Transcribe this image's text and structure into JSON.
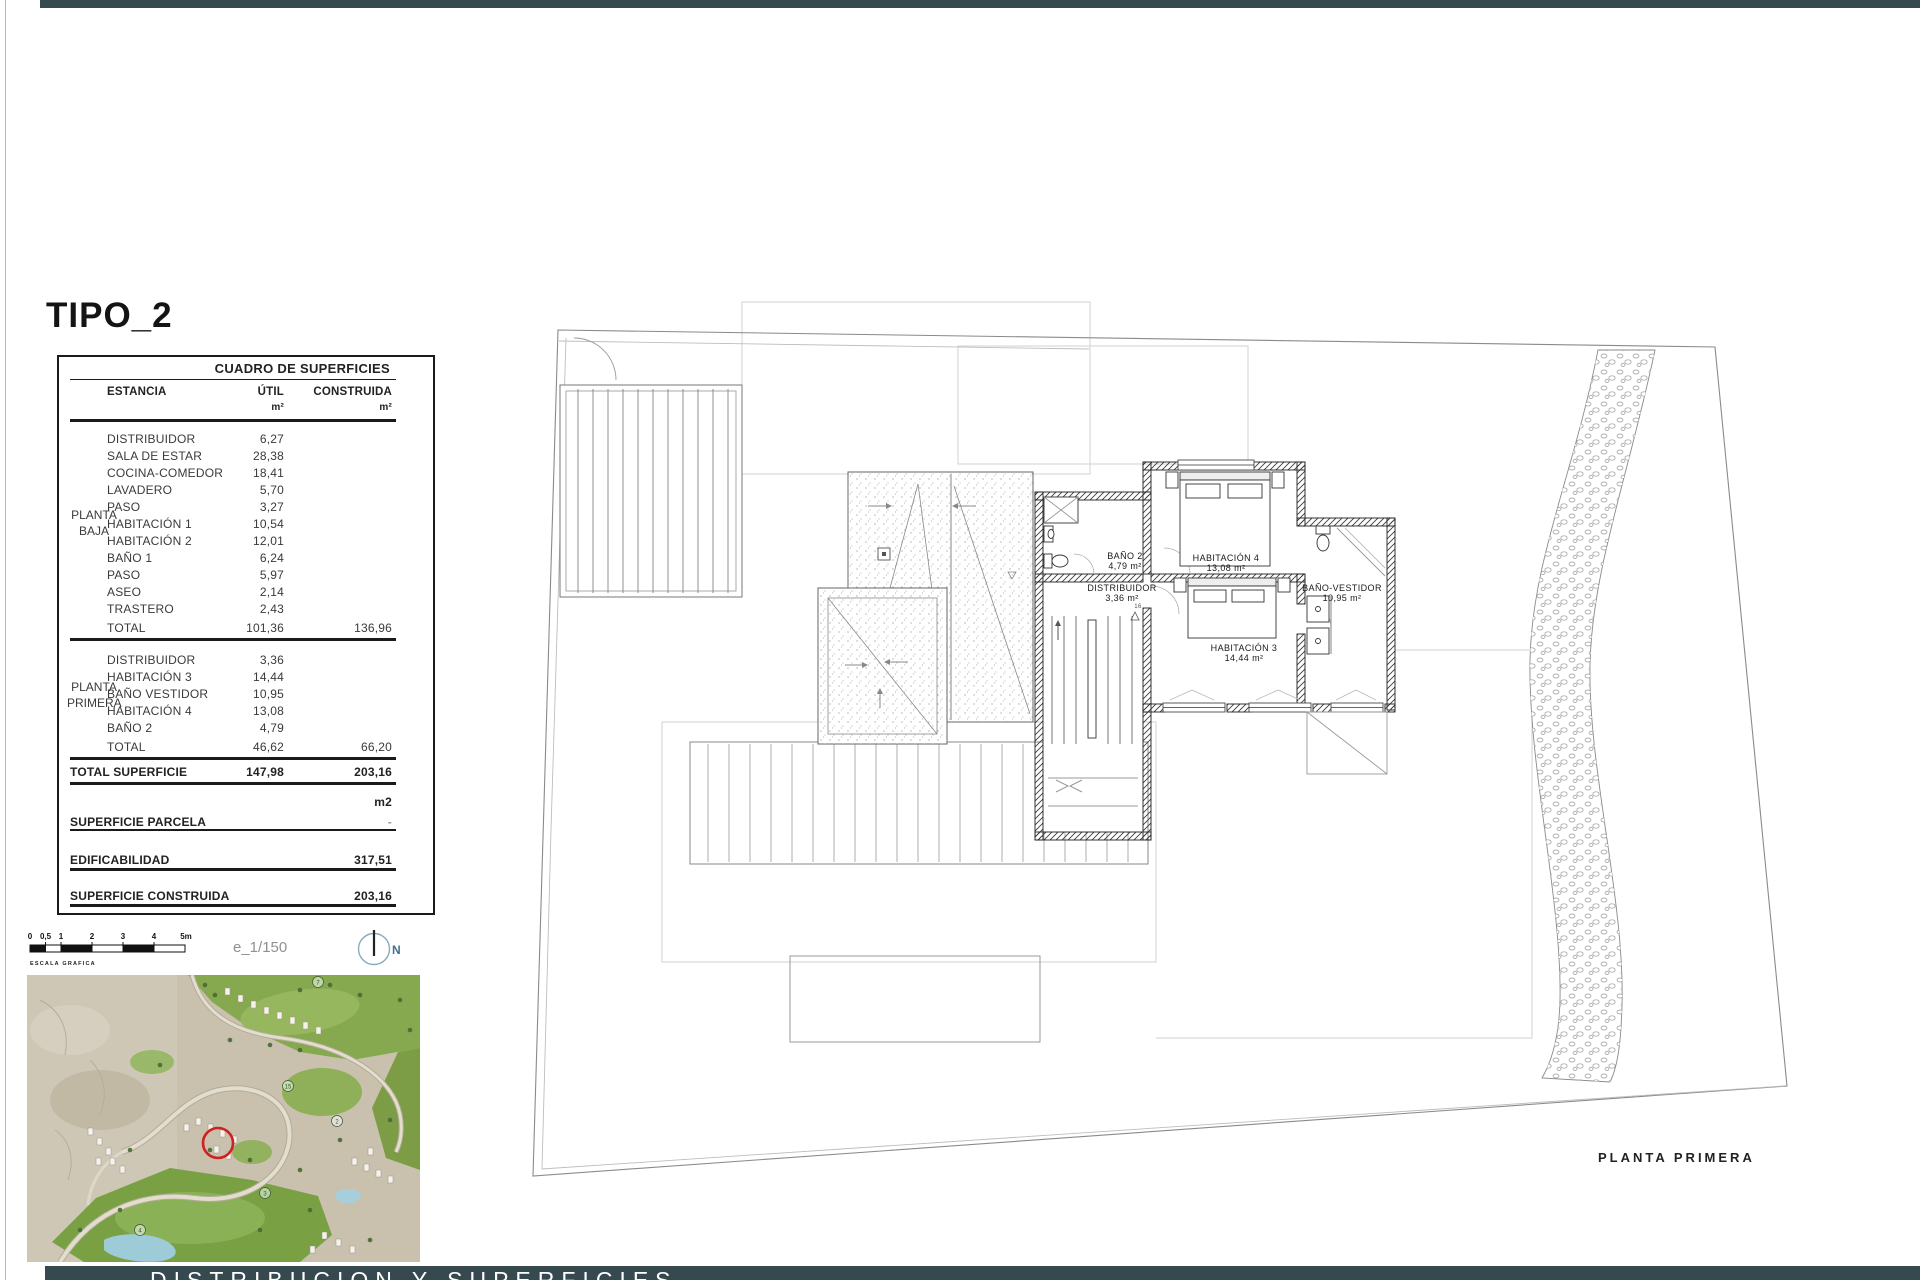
{
  "page": {
    "title": "TIPO_2",
    "footer_text": "DISTRIBUCION Y SUPERFICIES",
    "plan_caption": "PLANTA PRIMERA",
    "scale_text": "e_1/150",
    "scale_caption": "ESCALA GRAFICA",
    "north_label": "N",
    "scale_ticks": [
      "0",
      "0,5",
      "1",
      "2",
      "3",
      "4",
      "5m"
    ],
    "accent_color": "#35494e"
  },
  "table": {
    "title": "CUADRO DE SUPERFICIES",
    "columns": {
      "estancia": "ESTANCIA",
      "util": "ÚTIL",
      "construida": "CONSTRUIDA",
      "unit": "m²"
    },
    "planta_baja": {
      "label_line1": "PLANTA",
      "label_line2": "BAJA",
      "rows": [
        {
          "name": "DISTRIBUIDOR",
          "util": "6,27"
        },
        {
          "name": "SALA DE ESTAR",
          "util": "28,38"
        },
        {
          "name": "COCINA-COMEDOR",
          "util": "18,41"
        },
        {
          "name": "LAVADERO",
          "util": "5,70"
        },
        {
          "name": "PASO",
          "util": "3,27"
        },
        {
          "name": "HABITACIÓN 1",
          "util": "10,54"
        },
        {
          "name": "HABITACIÓN 2",
          "util": "12,01"
        },
        {
          "name": "BAÑO 1",
          "util": "6,24"
        },
        {
          "name": "PASO",
          "util": "5,97"
        },
        {
          "name": "ASEO",
          "util": "2,14"
        },
        {
          "name": "TRASTERO",
          "util": "2,43"
        }
      ],
      "total": {
        "name": "TOTAL",
        "util": "101,36",
        "construida": "136,96"
      }
    },
    "planta_primera": {
      "label_line1": "PLANTA",
      "label_line2": "PRIMERA",
      "rows": [
        {
          "name": "DISTRIBUIDOR",
          "util": "3,36"
        },
        {
          "name": "HABITACIÓN 3",
          "util": "14,44"
        },
        {
          "name": "BAÑO VESTIDOR",
          "util": "10,95"
        },
        {
          "name": "HABITACIÓN 4",
          "util": "13,08"
        },
        {
          "name": "BAÑO 2",
          "util": "4,79"
        }
      ],
      "total": {
        "name": "TOTAL",
        "util": "46,62",
        "construida": "66,20"
      }
    },
    "total_superficie": {
      "name": "TOTAL SUPERFICIE",
      "util": "147,98",
      "construida": "203,16"
    },
    "unit2": "m2",
    "superficie_parcela": {
      "name": "SUPERFICIE PARCELA",
      "value": "-"
    },
    "edificabilidad": {
      "name": "EDIFICABILIDAD",
      "value": "317,51"
    },
    "superficie_construida": {
      "name": "SUPERFICIE CONSTRUIDA",
      "value": "203,16"
    }
  },
  "plan": {
    "rooms": [
      {
        "name": "BAÑO 2",
        "area": "4,79 m²"
      },
      {
        "name": "HABITACIÓN 4",
        "area": "13,08 m²"
      },
      {
        "name": "DISTRIBUIDOR",
        "area": "3,36 m²"
      },
      {
        "name": "BAÑO-VESTIDOR",
        "area": "10,95 m²"
      },
      {
        "name": "HABITACIÓN 3",
        "area": "14,44 m²"
      }
    ],
    "stair_note": "16"
  },
  "map": {
    "badges": [
      "7",
      "15",
      "2",
      "3",
      "4"
    ]
  }
}
